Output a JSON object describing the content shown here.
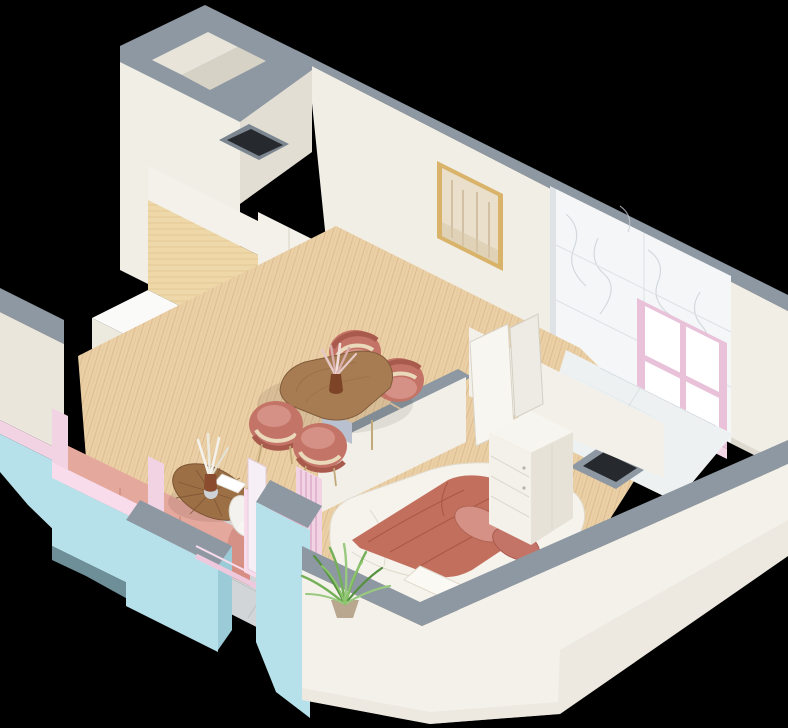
{
  "scene": {
    "title": "Isometric 3D cutaway render of a one-bedroom apartment floor plan",
    "style": "3d-isometric-cutaway-render",
    "background": "black",
    "rooms": [
      {
        "name": "kitchen-dining",
        "objects": [
          "tall-white-cabinets",
          "wood-backsplash-panel",
          "induction-cooktop",
          "built-in-oven",
          "sink-with-faucet",
          "round-serving-board",
          "oval-wood-dining-table",
          "four-terracotta-chairs",
          "vase-with-pampas-grass"
        ]
      },
      {
        "name": "living-area",
        "objects": [
          "pink-sofa",
          "round-segmented-coffee-table",
          "white-petal-chair",
          "vase-with-white-leaves",
          "magazine"
        ]
      },
      {
        "name": "bedroom",
        "objects": [
          "double-bed-white-linen",
          "terracotta-throw-blanket",
          "terracotta-pillows",
          "folded-white-blanket",
          "white-wardrobe",
          "pink-curtain"
        ]
      },
      {
        "name": "bathroom",
        "objects": [
          "marble-wall-tiles",
          "marble-floor",
          "pink-framed-window",
          "vanity-unit",
          "open-white-doors",
          "service-duct"
        ]
      },
      {
        "name": "balcony",
        "objects": [
          "gray-tile-floor",
          "pink-interior-walls",
          "green-plant",
          "pink-glazing-frame"
        ]
      },
      {
        "name": "entry-closet",
        "objects": [
          "full-height-walls",
          "service-shaft"
        ]
      }
    ],
    "decor": {
      "artwork": "framed-abstract-forest-print-in-gold-frame"
    }
  },
  "colors": {
    "background": "#000000",
    "wall_top": "#8e98a2",
    "wall_top_dark": "#7b8691",
    "wall_cream": "#f1eee6",
    "wall_cream_shade": "#e2ded3",
    "wall_cream_dark": "#d6d1c5",
    "floor_wood": "#ebd0a6",
    "floor_wood_line": "#bd9366",
    "floor_marble": "#eef1f2",
    "marble_wall": "#f4f6f7",
    "marble_vein": "#c6cdd4",
    "tile_gray": "#d2d5d7",
    "tile_seam": "#b7bcbf",
    "facade_blue": "#b7e1ea",
    "facade_blue_shade": "#9ccbd8",
    "pink_frame": "#f1d3e4",
    "pink_wall": "#f2a9c7",
    "pink_light": "#f8dcec",
    "terracotta": "#c47466",
    "terracotta_dark": "#a85a4d",
    "terracotta_light": "#d69186",
    "cushion_cream": "#ead9bb",
    "sofa_pink": "#d78e84",
    "sofa_pink_light": "#e5a89d",
    "bed_white": "#f6f3ed",
    "bed_shadow": "#ddd6c8",
    "throw": "#c26f5e",
    "table_wood": "#a87c52",
    "table_wood_dark": "#815c3b",
    "cabinet_white": "#f3f1ea",
    "cabinet_shade": "#e9e6dc",
    "counter_white": "#fafaf8",
    "kitchen_wood": "#eed7a8",
    "kitchen_wood_line": "#d2b175",
    "appliance_black": "#1c1e22",
    "steel": "#c2c9cf",
    "painting_frame": "#d8b369",
    "painting_canvas": "#e9dfca",
    "painting_stroke": "#c0a987",
    "plant_green": "#74b058",
    "plant_green_dark": "#55913f",
    "plant_green_light": "#98c97e",
    "glass_white": "#ffffff"
  }
}
